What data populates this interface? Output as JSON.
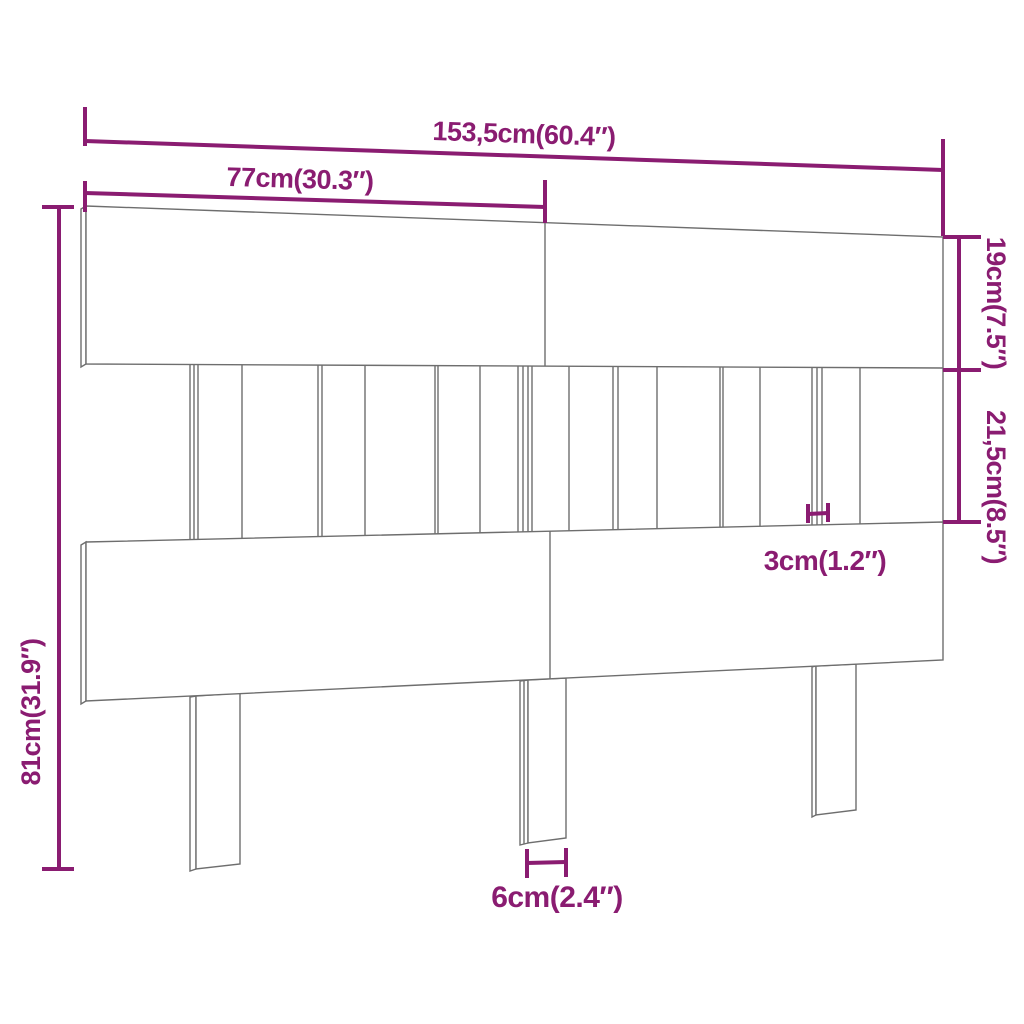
{
  "diagram": {
    "type": "furniture-dimension-diagram",
    "subject": "bed headboard with top rail, slatted middle section, bottom rail and three legs",
    "colors": {
      "dimension_accent": "#8a1c71",
      "outline": "#6e6e6e",
      "background": "#ffffff"
    },
    "dimensions": {
      "total_width": "153,5cm(60.4″)",
      "half_width": "77cm(30.3″)",
      "top_rail_height": "19cm(7.5″)",
      "slat_section_height": "21,5cm(8.5″)",
      "total_height": "81cm(31.9″)",
      "slat_width": "3cm(1.2″)",
      "leg_width": "6cm(2.4″)"
    }
  }
}
